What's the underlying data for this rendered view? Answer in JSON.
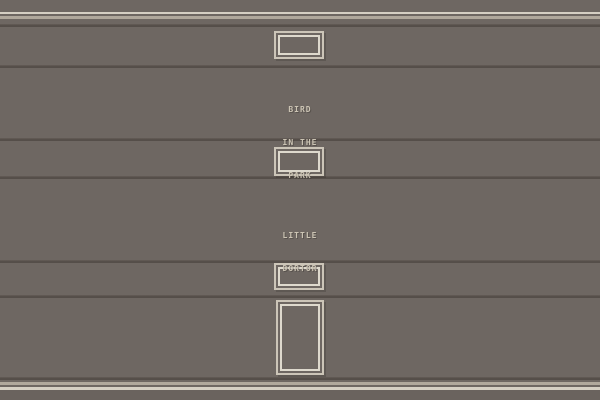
{
  "scene": {
    "description": "Pixel-art building facade with trim, stacked windows, a door and two wall signs",
    "signs": [
      {
        "id": "bird-in-the-park",
        "lines": [
          "BIRD",
          "IN THE",
          "PARK"
        ]
      },
      {
        "id": "little-dortor",
        "lines": [
          "LITTLE",
          "DORTOR"
        ]
      }
    ],
    "colors": {
      "wall": "#6e6762",
      "wall_bottom": "#6a635e",
      "trim_bright": "#d5cfc3",
      "trim_dim": "#b0a89c",
      "separator_dark": "#554e49",
      "separator_mid": "#675f59",
      "frame_outer": "#ccc5b8",
      "frame_inner": "#ded9cd",
      "text": "#ccc4b4"
    }
  }
}
